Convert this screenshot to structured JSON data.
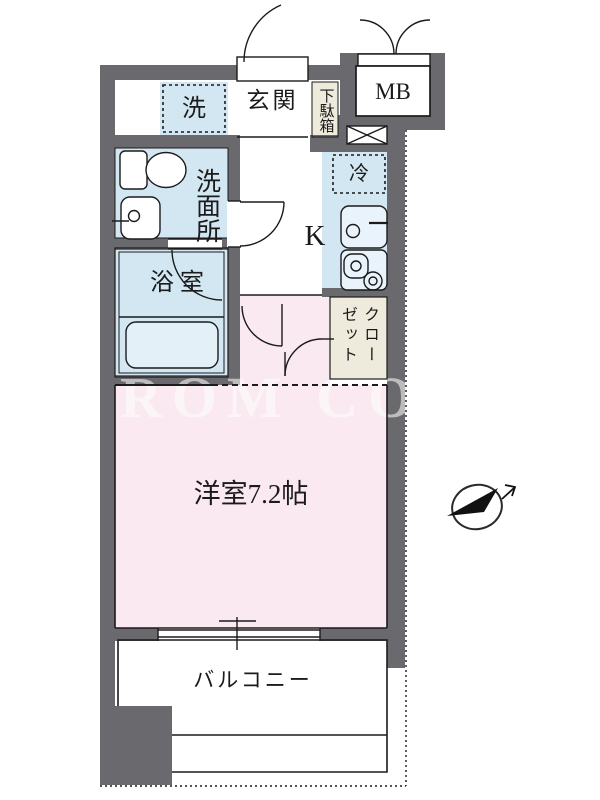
{
  "colors": {
    "wall": "#6a6a6e",
    "waterblue": "#d3e7f3",
    "roompink": "#fae9f0",
    "beige": "#eeebdc",
    "unit": "#e9f3fb",
    "line": "#1b1b1b",
    "watermark": "#ffffff"
  },
  "watermark": {
    "text": "ROM COR"
  },
  "rooms": {
    "washer": {
      "label": "洗"
    },
    "entrance": {
      "label": "玄関"
    },
    "shoe_cabinet": {
      "label": "下駄箱"
    },
    "meter_box": {
      "label": "MB"
    },
    "washroom": {
      "label": "洗面所"
    },
    "refrigerator": {
      "label": "冷"
    },
    "kitchen": {
      "label": "K"
    },
    "bathroom": {
      "label": "浴室"
    },
    "closet": {
      "label": "クローゼット"
    },
    "western_room": {
      "label": "洋室7.2帖",
      "size_tatami": 7.2
    },
    "balcony": {
      "label": "バルコニー"
    }
  },
  "icons": {
    "compass": "north-arrow-icon",
    "toilet": "toilet-icon",
    "washbasin": "washbasin-icon",
    "bathtub": "bathtub-icon",
    "kitchen_sink": "kitchen-sink-icon",
    "stove": "stove-icon",
    "pipe_space": "crossed-box-icon"
  }
}
